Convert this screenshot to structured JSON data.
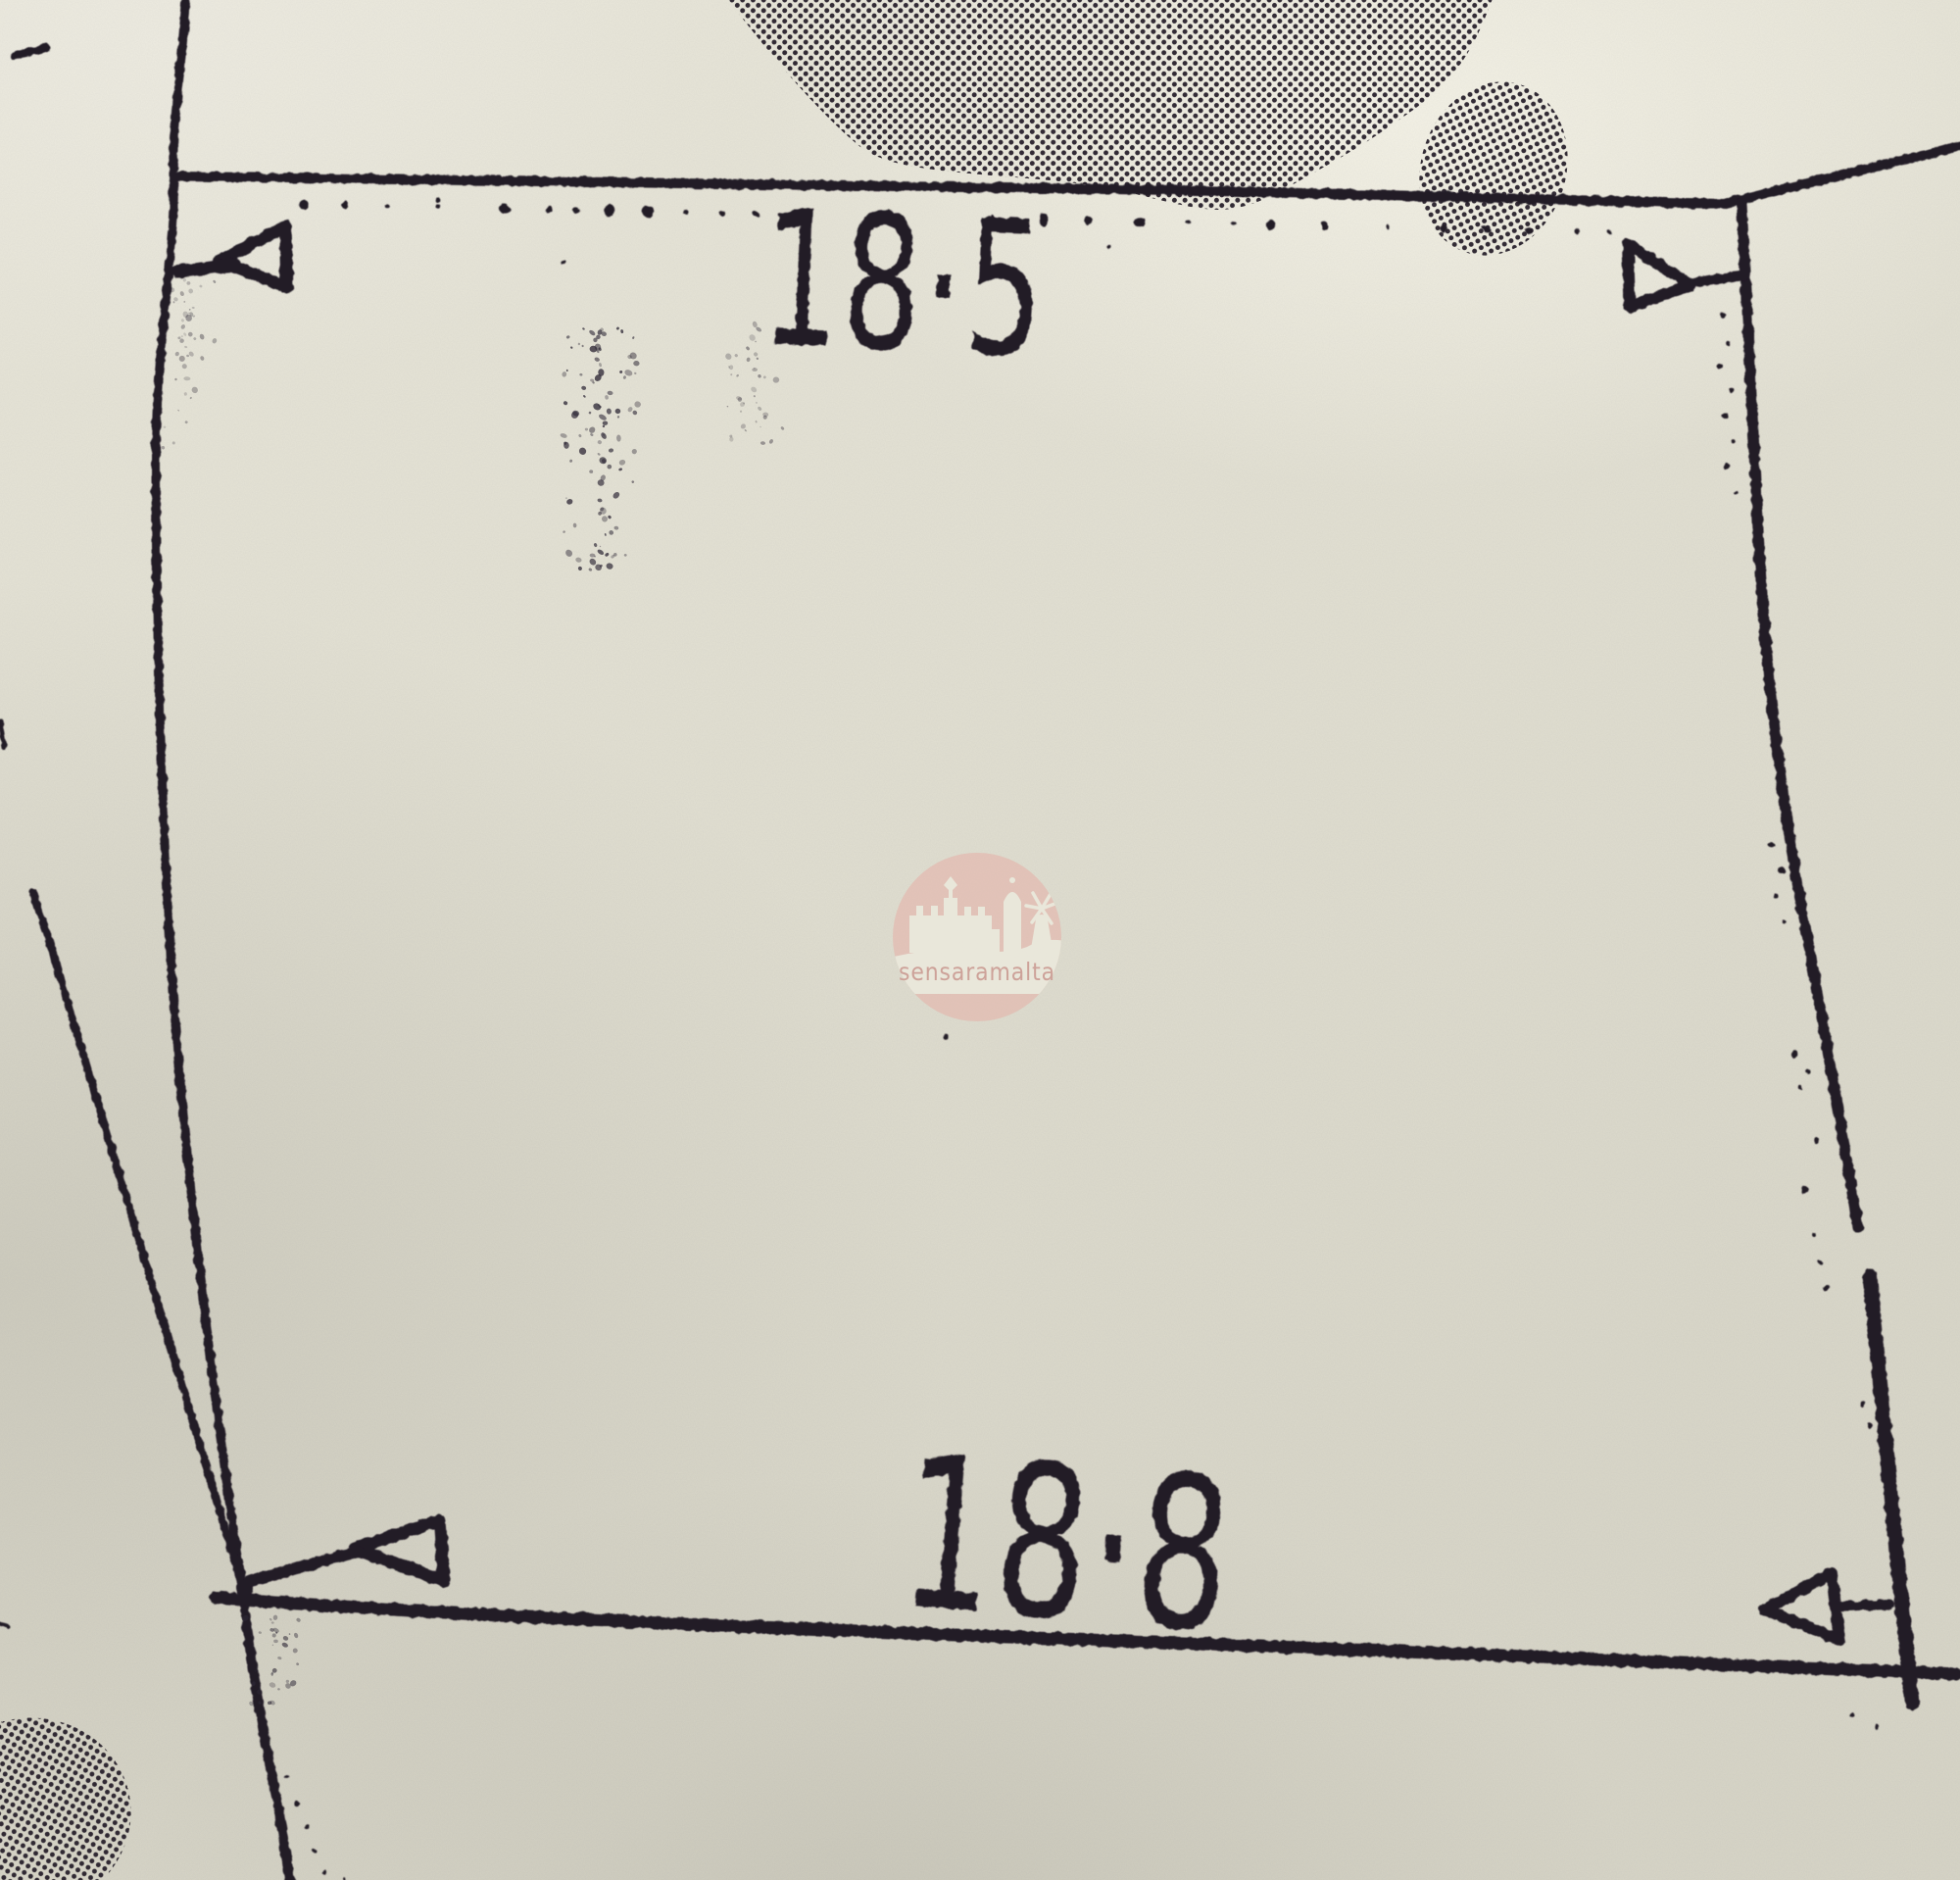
{
  "plan": {
    "top_dimension_label": "18·5",
    "bottom_dimension_label": "18·8"
  },
  "watermark": {
    "text": "sensaramalta",
    "logo_icon": "castle-windmill-skyline-icon"
  },
  "icons": {
    "survey_arrow": "survey-arrow-icon"
  },
  "colors": {
    "paper": "#e1dfd1",
    "ink": "#221a26",
    "stipple": "#2e2836",
    "watermark_pink": "#e3b4aa",
    "watermark_text": "#cb9a92",
    "watermark_silhouette": "#ebe9dc"
  }
}
